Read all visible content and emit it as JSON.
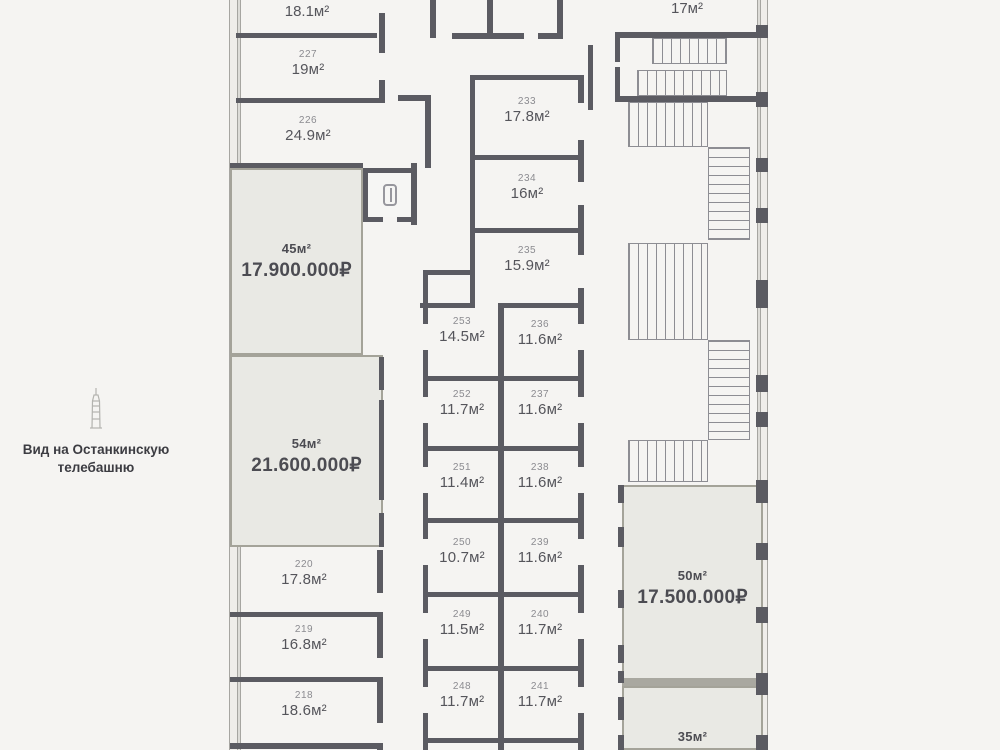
{
  "title": "Поэтажный план",
  "colors": {
    "background": "#f5f4f2",
    "wall": "#5b5b62",
    "highlight_fill": "#e9e9e4",
    "highlight_border": "#a4a399"
  },
  "view_note": {
    "line1": "Вид на Останкинскую",
    "line2": "телебашню",
    "icon": "ostankino-tower-icon"
  },
  "partial_labels": {
    "top_left_area": "18.1м²",
    "top_right_area": "17м²"
  },
  "units": [
    {
      "area": "45м²",
      "price": "17.900.000₽"
    },
    {
      "area": "54м²",
      "price": "21.600.000₽"
    },
    {
      "area": "50м²",
      "price": "17.500.000₽"
    },
    {
      "area": "35м²",
      "price": ""
    }
  ],
  "rooms": [
    {
      "number": "227",
      "area": "19м²"
    },
    {
      "number": "226",
      "area": "24.9м²"
    },
    {
      "number": "220",
      "area": "17.8м²"
    },
    {
      "number": "219",
      "area": "16.8м²"
    },
    {
      "number": "218",
      "area": "18.6м²"
    },
    {
      "number": "233",
      "area": "17.8м²"
    },
    {
      "number": "234",
      "area": "16м²"
    },
    {
      "number": "235",
      "area": "15.9м²"
    },
    {
      "number": "253",
      "area": "14.5м²"
    },
    {
      "number": "236",
      "area": "11.6м²"
    },
    {
      "number": "252",
      "area": "11.7м²"
    },
    {
      "number": "237",
      "area": "11.6м²"
    },
    {
      "number": "251",
      "area": "11.4м²"
    },
    {
      "number": "238",
      "area": "11.6м²"
    },
    {
      "number": "250",
      "area": "10.7м²"
    },
    {
      "number": "239",
      "area": "11.6м²"
    },
    {
      "number": "249",
      "area": "11.5м²"
    },
    {
      "number": "240",
      "area": "11.7м²"
    },
    {
      "number": "248",
      "area": "11.7м²"
    },
    {
      "number": "241",
      "area": "11.7м²"
    }
  ]
}
